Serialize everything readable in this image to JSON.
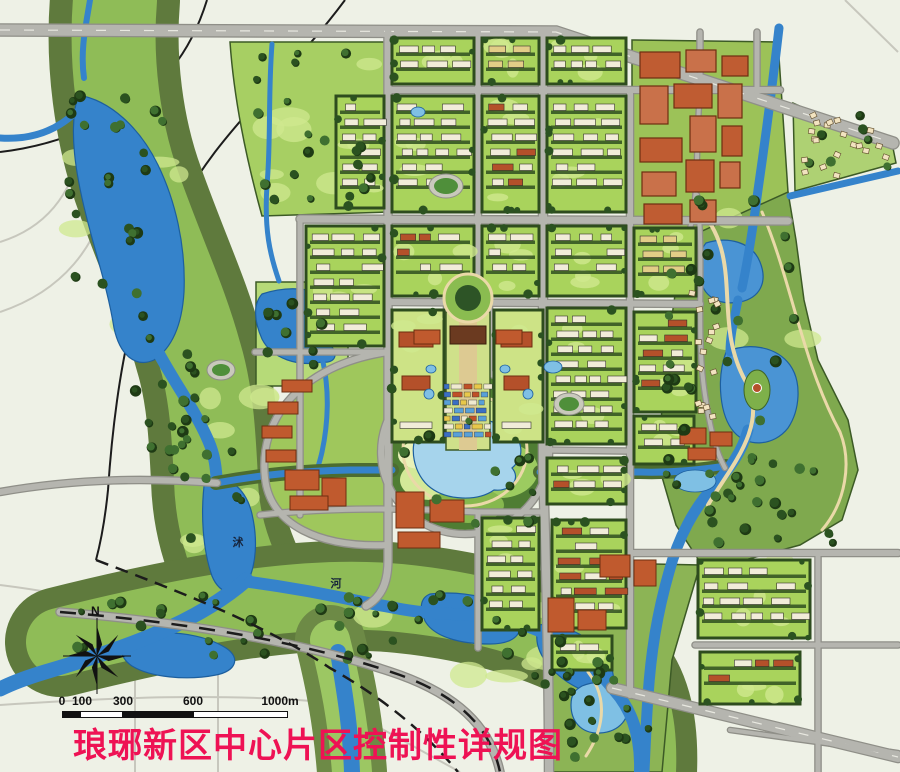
{
  "title": {
    "text": "琅琊新区中心片区控制性详规图",
    "color": "#ee1254"
  },
  "compass": {
    "label": "N",
    "cx": 97,
    "cy": 656,
    "r": 30
  },
  "scalebar": {
    "label_y": 694,
    "ticks": [
      {
        "label": "0",
        "x": 62
      },
      {
        "label": "100",
        "x": 82
      },
      {
        "label": "300",
        "x": 123
      },
      {
        "label": "600",
        "x": 193
      },
      {
        "label": "1000m",
        "x": 280
      }
    ],
    "bar": {
      "y": 711,
      "h": 7,
      "segments": [
        [
          62,
          80,
          "#111111"
        ],
        [
          80,
          123,
          "#ffffff"
        ],
        [
          123,
          193,
          "#111111"
        ],
        [
          193,
          288,
          "#ffffff"
        ]
      ]
    }
  },
  "map": {
    "colors": {
      "bg": "#eef1e6",
      "ghost": "#c7c7bd",
      "roadCase": "#8f8f88",
      "roadFill": "#b5b5af",
      "water": "#3583cb",
      "waterEdge": "#1d5f9e",
      "waterLight": "#a6d4ec",
      "bank": "#4c6c30",
      "blockEdge": "#2e4c1e",
      "buildingWhite": "#f1ecd9",
      "roofRed": "#b4502a",
      "roofTan": "#e2cd87",
      "treeDark": "#2b5220",
      "parkLight": "#b6da78",
      "path": "#ead9a8",
      "title": "#ee1254"
    },
    "ghost_roads": [
      [
        "M0,242 C45,228 72,195 80,148 C86,108 82,55 62,8",
        2
      ],
      [
        "M0,312 C60,292 100,248 110,182 C114,150 112,110 104,70",
        2
      ],
      [
        "M0,585 C80,595 150,612 218,640 L218,772",
        2
      ],
      [
        "M135,662 L135,772",
        2
      ],
      [
        "M0,705 C110,698 220,692 335,703 L460,772",
        2
      ],
      [
        "M335,703 L335,772",
        2
      ],
      [
        "M845,0 L898,52",
        2
      ]
    ],
    "black_under": [
      [
        "M207,0 C190,55 160,90 115,115 C75,137 35,148 0,152",
        2,
        ""
      ],
      [
        "M345,0 C302,58 255,100 215,152 C175,205 148,262 132,322 C120,368 112,430 108,490 C105,520 100,545 96,560",
        2,
        ""
      ]
    ],
    "black_over": [
      [
        "M96,560 C180,592 260,622 330,668 C390,702 430,738 458,772",
        2.5,
        "13 8"
      ],
      [
        "M60,612 C180,622 300,640 400,675 C455,695 490,725 500,772",
        2.5,
        "16 12"
      ]
    ],
    "corridors": [
      {
        "d": "M115,0 C110,60 118,130 140,190 C165,260 185,300 200,355 C212,395 214,440 216,480 C217,520 228,552 240,578",
        "layers": [
          [
            130,
            "#5f7a3d"
          ],
          [
            84,
            "#8fbc57"
          ]
        ]
      },
      {
        "d": "M60,642 C180,612 300,588 400,598 C480,606 560,628 608,662 C636,684 644,724 642,772",
        "layers": [
          [
            110,
            "#5f7a3d"
          ],
          [
            68,
            "#8fbc57"
          ]
        ]
      },
      {
        "d": "M330,640 C340,680 348,720 352,772",
        "layers": [
          [
            70,
            "#6d8a46"
          ],
          [
            40,
            "#9cc763"
          ]
        ]
      }
    ],
    "park_polys": [
      {
        "name": "park-northwest",
        "d": "M230,42 L388,42 L388,212 L262,216 C246,158 234,100 230,42 Z",
        "fill": "#a7cf63"
      },
      {
        "name": "park-west-lake",
        "d": "M256,282 L348,282 L348,386 L256,386 Z",
        "fill": "#b6da78"
      },
      {
        "name": "park-east",
        "d": "M697,192 L788,192 L796,240 L804,300 L818,360 L848,420 L858,470 L842,520 L800,545 L745,560 L700,562 L676,525 L660,470 L662,400 L670,330 L680,260 Z",
        "fill": "#7fa94e"
      },
      {
        "name": "park-southeast",
        "d": "M552,562 L700,565 L672,660 L662,772 L552,772 Z",
        "fill": "#8cb455"
      },
      {
        "name": "residential-wedge-ne",
        "d": "M793,103 L893,148 L896,163 L795,191 Z",
        "fill": "#aed173"
      },
      {
        "name": "commercial-zone",
        "d": "M632,40 L778,42 L788,192 L700,232 L632,232 Z",
        "fill": "#9cc258"
      },
      {
        "name": "crescent-quarter",
        "d": "M388,352 C300,365 258,420 265,478 C270,525 320,548 388,545 Z",
        "fill": "#9fc75c"
      }
    ],
    "central_park": {
      "cx": 465,
      "cy": 450,
      "rx": 82,
      "ry": 80,
      "fill": "#4f7d33",
      "blobs": [
        [
          440,
          420,
          40,
          26,
          "#86b84e"
        ],
        [
          500,
          470,
          38,
          28,
          "#9ccb60"
        ],
        [
          430,
          480,
          30,
          20,
          "#d3e998"
        ],
        [
          505,
          415,
          26,
          16,
          "#cfe792"
        ],
        [
          468,
          505,
          36,
          18,
          "#86b84e"
        ],
        [
          420,
          455,
          22,
          14,
          "#e9f2b8"
        ]
      ],
      "walk": {
        "rx": 62,
        "ry": 56
      },
      "island": {
        "cx": 757,
        "cy": 390,
        "rx": 13,
        "ry": 20,
        "fill": "#7eb04a",
        "pavilion": "#b4502a"
      }
    },
    "water_fills": [
      {
        "d": "M78,95 C110,100 140,128 158,165 C175,200 186,245 184,292 C182,325 172,348 154,360 C136,368 120,356 114,328 C108,290 96,255 86,215 C76,175 68,130 78,95 Z"
      },
      {
        "d": "M205,478 C226,472 246,488 252,514 C258,540 256,564 248,582 C238,598 220,596 212,576 C203,550 200,514 205,478 Z"
      },
      {
        "d": "M128,638 C162,628 202,633 226,648 C241,658 236,671 216,675 C186,681 150,677 132,666 C120,658 118,646 128,638 Z"
      },
      {
        "d": "M430,594 C466,590 502,599 516,617 C526,631 516,644 490,644 C460,644 434,637 425,621 C419,609 420,598 430,594 Z"
      },
      {
        "d": "M545,624 C576,627 601,644 611,667 C619,687 606,699 585,691 C559,681 539,659 537,641 C536,629 538,624 545,624 Z"
      },
      {
        "d": "M262,294 C292,284 322,289 336,304 C349,317 346,336 331,346 C339,354 335,364 322,362 C299,367 272,359 262,339 C254,321 253,304 262,294 Z"
      },
      {
        "d": "M706,243 C728,236 752,242 760,262 C768,282 760,298 740,302 C718,306 702,296 700,276 C699,260 700,250 706,243 Z",
        "fill": "#4a94d4"
      },
      {
        "d": "M726,352 C748,342 776,346 790,365 C802,382 800,410 788,428 C774,446 748,448 734,432 C720,416 716,380 726,352 Z",
        "fill": "#4a94d4"
      },
      {
        "d": "M582,686 C602,678 622,684 627,700 C632,718 619,732 600,733 C581,734 571,721 571,705 C571,694 575,690 582,686 Z",
        "fill": "#7fc0e4"
      },
      {
        "d": "M420,428 C446,414 482,414 506,428 C523,438 526,456 512,468 C521,478 512,492 494,490 C477,502 447,500 431,488 C414,476 407,446 420,428 Z",
        "fill": "#a6d4ec"
      }
    ],
    "water_strokes": [
      {
        "d": "M90,0 C86,25 80,50 84,78",
        "w": 6
      },
      {
        "d": "M0,138 C30,140 55,132 76,112",
        "w": 7
      },
      {
        "d": "M158,352 C176,385 196,412 208,440 C215,456 216,468 217,484",
        "w": 12
      },
      {
        "d": "M246,580 C196,624 120,650 45,672 C25,678 10,684 0,689",
        "w": 15
      },
      {
        "d": "M250,582 C310,590 350,600 395,608 C440,617 470,611 510,621 C560,634 590,660 614,690 C634,712 641,740 640,772",
        "w": 12
      },
      {
        "d": "M338,652 C344,690 350,720 352,772",
        "w": 16
      },
      {
        "d": "M272,44 C268,95 271,140 267,185 C264,230 270,255 279,281",
        "w": 5
      },
      {
        "d": "M322,358 C330,390 328,424 322,452 C320,461 318,466 317,471",
        "w": 5
      },
      {
        "d": "M216,483 C260,475 300,471 350,470 L392,470",
        "w": 7,
        "edge": true
      },
      {
        "d": "M540,472 L640,472 C670,473 700,470 726,466",
        "w": 7,
        "edge": true
      },
      {
        "d": "M779,28 C773,80 766,135 758,190 C752,235 748,260 742,288",
        "w": 9
      },
      {
        "d": "M738,300 C734,320 730,335 730,352",
        "w": 9
      },
      {
        "d": "M748,430 C742,452 730,468 714,486 C694,508 678,538 669,572 C657,614 651,652 648,696 C646,726 645,748 644,772",
        "w": 11
      },
      {
        "d": "M790,196 L898,171",
        "w": 7
      }
    ],
    "cream_paths": [
      [
        "M702,212 C744,262 712,322 746,382 C770,426 728,470 708,505",
        4
      ],
      [
        "M762,212 C792,282 802,362 840,432 C852,462 846,502 822,530",
        3
      ],
      [
        "M588,672 C610,700 602,732 586,756",
        3
      ]
    ],
    "roads": [
      {
        "d": "M0,30 L556,32 L893,143",
        "w": 11,
        "hw": true
      },
      {
        "d": "M388,90 L780,90",
        "w": 6
      },
      {
        "d": "M300,219 L788,221",
        "w": 7
      },
      {
        "d": "M388,302 L700,304",
        "w": 6
      },
      {
        "d": "M255,352 L388,352",
        "w": 5
      },
      {
        "d": "M543,450 L700,452",
        "w": 5
      },
      {
        "d": "M260,515 C340,506 420,509 478,512 L545,512",
        "w": 5
      },
      {
        "d": "M620,553 L898,553",
        "w": 6
      },
      {
        "d": "M695,645 L898,645",
        "w": 5
      },
      {
        "d": "M612,688 L898,757",
        "w": 10,
        "hw": true
      },
      {
        "d": "M60,612 C180,622 300,640 400,675 C455,695 490,725 500,772",
        "w": 7
      },
      {
        "d": "M388,32 L388,560 C388,585 380,598 366,606",
        "w": 7
      },
      {
        "d": "M478,32 L478,302",
        "w": 6
      },
      {
        "d": "M478,512 L478,648",
        "w": 5
      },
      {
        "d": "M543,32 L543,470 C546,560 549,660 549,772",
        "w": 8
      },
      {
        "d": "M630,90 L630,695",
        "w": 6
      },
      {
        "d": "M700,32 L700,92",
        "w": 5
      },
      {
        "d": "M757,32 L757,92",
        "w": 5
      },
      {
        "d": "M300,219 L300,515",
        "w": 5
      },
      {
        "d": "M818,553 L818,772",
        "w": 5
      },
      {
        "d": "M0,492 C80,478 150,478 217,483",
        "w": 6
      },
      {
        "d": "M388,352 C300,365 258,420 265,478 C270,525 320,548 388,545",
        "w": 6
      },
      {
        "d": "M465,370 a84,82 0 1 0 0.2,0",
        "w": 6
      },
      {
        "d": "M697,195 C705,260 695,330 705,395 C712,440 718,455 725,468",
        "w": 4
      },
      {
        "d": "M730,730 L898,753",
        "w": 4
      },
      {
        "d": "M700,92 C695,150 700,200 688,235",
        "w": 4
      },
      {
        "d": "M446,302 L446,372",
        "w": 4
      },
      {
        "d": "M490,302 L490,372",
        "w": 4
      }
    ],
    "blocks": [
      [
        392,
        38,
        82,
        46,
        "g",
        11
      ],
      [
        482,
        38,
        57,
        46,
        "y",
        12
      ],
      [
        547,
        38,
        79,
        46,
        "g",
        13
      ],
      [
        336,
        96,
        48,
        112,
        "g",
        14
      ],
      [
        392,
        96,
        82,
        116,
        "g",
        15
      ],
      [
        482,
        96,
        57,
        116,
        "gr",
        16
      ],
      [
        547,
        96,
        79,
        116,
        "g",
        17
      ],
      [
        306,
        226,
        78,
        120,
        "g",
        18
      ],
      [
        392,
        226,
        82,
        70,
        "gr",
        19
      ],
      [
        482,
        226,
        57,
        70,
        "gr",
        20
      ],
      [
        547,
        226,
        79,
        70,
        "g",
        21
      ],
      [
        634,
        228,
        62,
        68,
        "y",
        22
      ],
      [
        392,
        310,
        52,
        132,
        "cv",
        23
      ],
      [
        494,
        310,
        49,
        132,
        "cv",
        24
      ],
      [
        547,
        308,
        79,
        136,
        "g",
        25
      ],
      [
        634,
        312,
        62,
        100,
        "gr",
        26
      ],
      [
        634,
        416,
        60,
        48,
        "g",
        27
      ],
      [
        547,
        458,
        79,
        46,
        "gr",
        28
      ],
      [
        482,
        518,
        57,
        112,
        "g",
        29
      ],
      [
        552,
        520,
        74,
        108,
        "gr",
        30
      ],
      [
        552,
        636,
        60,
        34,
        "g",
        31
      ],
      [
        698,
        560,
        112,
        78,
        "g",
        32
      ],
      [
        700,
        652,
        100,
        52,
        "gr",
        33
      ]
    ],
    "big_buildings": [
      [
        640,
        52,
        40,
        26
      ],
      [
        686,
        50,
        30,
        22
      ],
      [
        722,
        56,
        26,
        20
      ],
      [
        640,
        86,
        28,
        38
      ],
      [
        674,
        84,
        38,
        24
      ],
      [
        718,
        84,
        24,
        34
      ],
      [
        640,
        138,
        42,
        24
      ],
      [
        690,
        116,
        26,
        36
      ],
      [
        722,
        126,
        20,
        30
      ],
      [
        642,
        172,
        34,
        24
      ],
      [
        686,
        160,
        28,
        32
      ],
      [
        720,
        162,
        20,
        26
      ],
      [
        644,
        204,
        38,
        20
      ],
      [
        690,
        200,
        26,
        22
      ]
    ],
    "clusters": [
      [
        [
          285,
          470,
          34,
          20
        ],
        [
          322,
          478,
          24,
          28
        ],
        [
          290,
          496,
          38,
          14
        ]
      ],
      [
        [
          396,
          492,
          28,
          36
        ],
        [
          430,
          500,
          34,
          22
        ],
        [
          398,
          532,
          42,
          16
        ]
      ],
      [
        [
          600,
          555,
          30,
          22
        ],
        [
          634,
          560,
          22,
          26
        ]
      ],
      [
        [
          548,
          598,
          26,
          34
        ],
        [
          578,
          610,
          28,
          20
        ]
      ],
      [
        [
          680,
          428,
          26,
          16
        ],
        [
          710,
          432,
          22,
          14
        ],
        [
          688,
          448,
          28,
          12
        ]
      ],
      [
        [
          282,
          380,
          30,
          12
        ],
        [
          268,
          402,
          30,
          12
        ],
        [
          262,
          426,
          30,
          12
        ],
        [
          266,
          450,
          30,
          12
        ]
      ],
      [
        [
          414,
          330,
          26,
          14
        ],
        [
          496,
          330,
          26,
          14
        ]
      ]
    ],
    "axis": {
      "plaza": [
        468,
        298,
        24,
        13
      ],
      "corridor": [
        446,
        312,
        44,
        138
      ],
      "strip": [
        459,
        312,
        18,
        138
      ],
      "hall": [
        450,
        326,
        36,
        18
      ],
      "market": [
        444,
        384,
        48,
        58
      ],
      "market_colors": [
        "#3a6fc4",
        "#e8c84a",
        "#c05028",
        "#f0ead0",
        "#58a0d8"
      ]
    },
    "stadiums": [
      [
        446,
        186,
        17,
        12
      ],
      [
        569,
        404,
        15,
        11
      ],
      [
        221,
        370,
        14,
        10
      ]
    ],
    "ponds": [
      [
        418,
        112,
        7,
        5
      ],
      [
        553,
        367,
        9,
        6
      ],
      [
        431,
        369,
        5,
        4
      ],
      [
        505,
        369,
        5,
        4
      ],
      [
        695,
        481,
        21,
        11
      ]
    ],
    "scatter": [
      [
        "tree",
        60,
        85,
        110,
        250,
        24,
        101
      ],
      [
        "tree",
        125,
        330,
        85,
        130,
        14,
        102
      ],
      [
        "tree",
        168,
        415,
        80,
        130,
        12,
        103
      ],
      [
        "tree",
        75,
        595,
        190,
        60,
        16,
        104
      ],
      [
        "tree",
        290,
        585,
        230,
        75,
        18,
        105
      ],
      [
        "tree",
        520,
        612,
        120,
        110,
        14,
        106
      ],
      [
        "tree",
        660,
        200,
        140,
        330,
        36,
        107
      ],
      [
        "tree",
        700,
        440,
        140,
        110,
        14,
        108
      ],
      [
        "tree",
        235,
        48,
        145,
        158,
        20,
        109
      ],
      [
        "tree",
        560,
        672,
        90,
        90,
        10,
        110
      ],
      [
        "tree",
        800,
        110,
        88,
        70,
        7,
        111
      ],
      [
        "tree",
        258,
        286,
        88,
        96,
        9,
        112
      ],
      [
        "tree",
        380,
        375,
        180,
        155,
        12,
        113
      ],
      [
        "lawn",
        70,
        120,
        120,
        230,
        7,
        201
      ],
      [
        "lawn",
        180,
        380,
        110,
        170,
        7,
        202
      ],
      [
        "lawn",
        300,
        598,
        250,
        80,
        9,
        203
      ],
      [
        "lawn",
        662,
        215,
        145,
        320,
        12,
        204
      ],
      [
        "lawn",
        238,
        60,
        135,
        145,
        7,
        205
      ],
      [
        "lawn",
        706,
        560,
        100,
        120,
        6,
        206
      ],
      [
        "cot",
        800,
        114,
        84,
        64,
        20,
        301
      ],
      [
        "cot",
        685,
        290,
        30,
        82,
        12,
        302
      ],
      [
        "cot",
        687,
        392,
        24,
        28,
        5,
        303
      ]
    ],
    "labels": [
      {
        "text": "沭",
        "x": 238,
        "y": 542
      },
      {
        "text": "河",
        "x": 336,
        "y": 583
      }
    ]
  }
}
